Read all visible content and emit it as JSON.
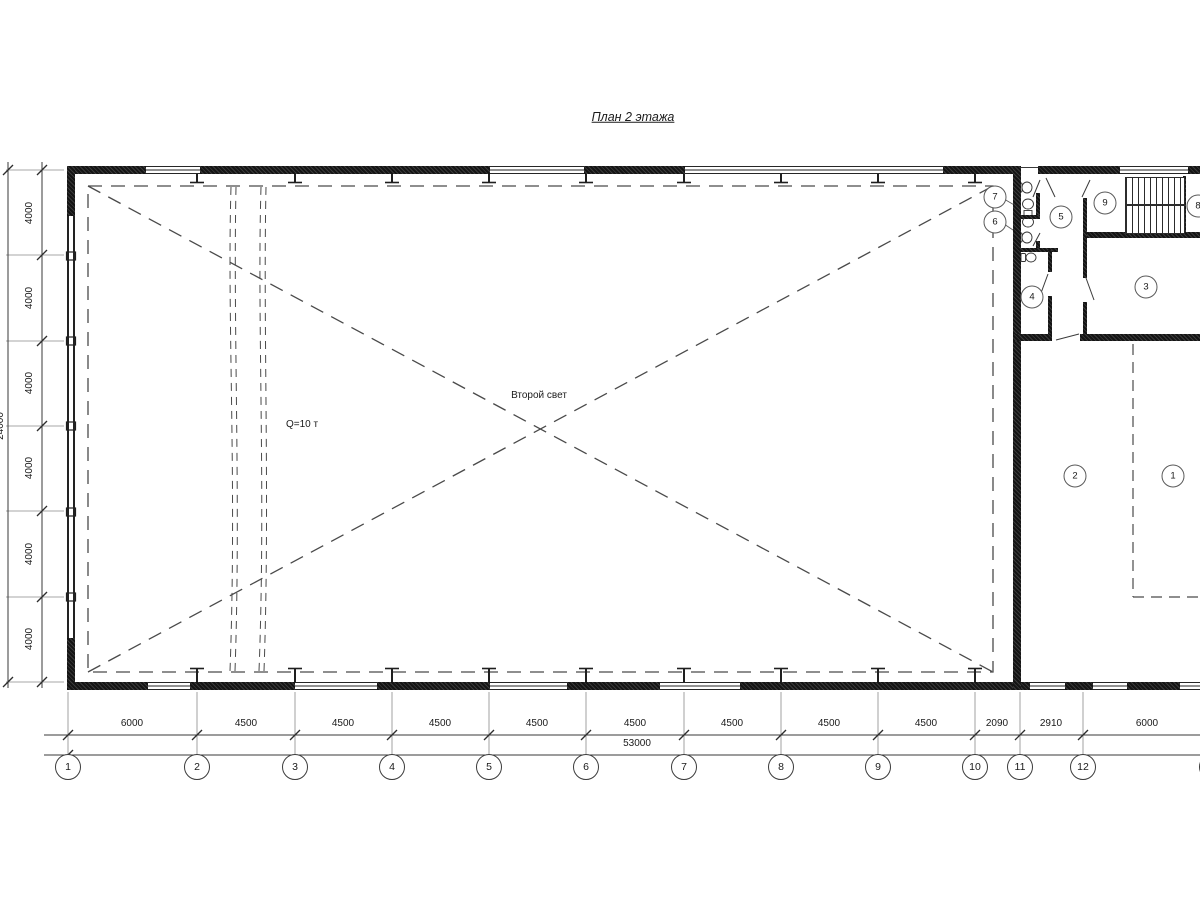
{
  "title": "План 2 этажа",
  "annotations": {
    "second_light": "Второй свет",
    "crane_capacity": "Q=10 т"
  },
  "dimensions": {
    "bottom": [
      "6000",
      "4500",
      "4500",
      "4500",
      "4500",
      "4500",
      "4500",
      "4500",
      "4500",
      "2090",
      "2910",
      "6000"
    ],
    "bottom_total": "53000",
    "left": [
      "4000",
      "4000",
      "4000",
      "4000",
      "4000",
      "4000"
    ],
    "left_total": "24000"
  },
  "grid_axes": [
    "1",
    "2",
    "3",
    "4",
    "5",
    "6",
    "7",
    "8",
    "9",
    "10",
    "11",
    "12",
    "13"
  ],
  "room_numbers": [
    "1",
    "2",
    "3",
    "4",
    "5",
    "6",
    "7",
    "8",
    "9"
  ],
  "colors": {
    "wall": "#1f1f1f",
    "line": "#3a3a3a",
    "dash": "#4a4a4a"
  }
}
